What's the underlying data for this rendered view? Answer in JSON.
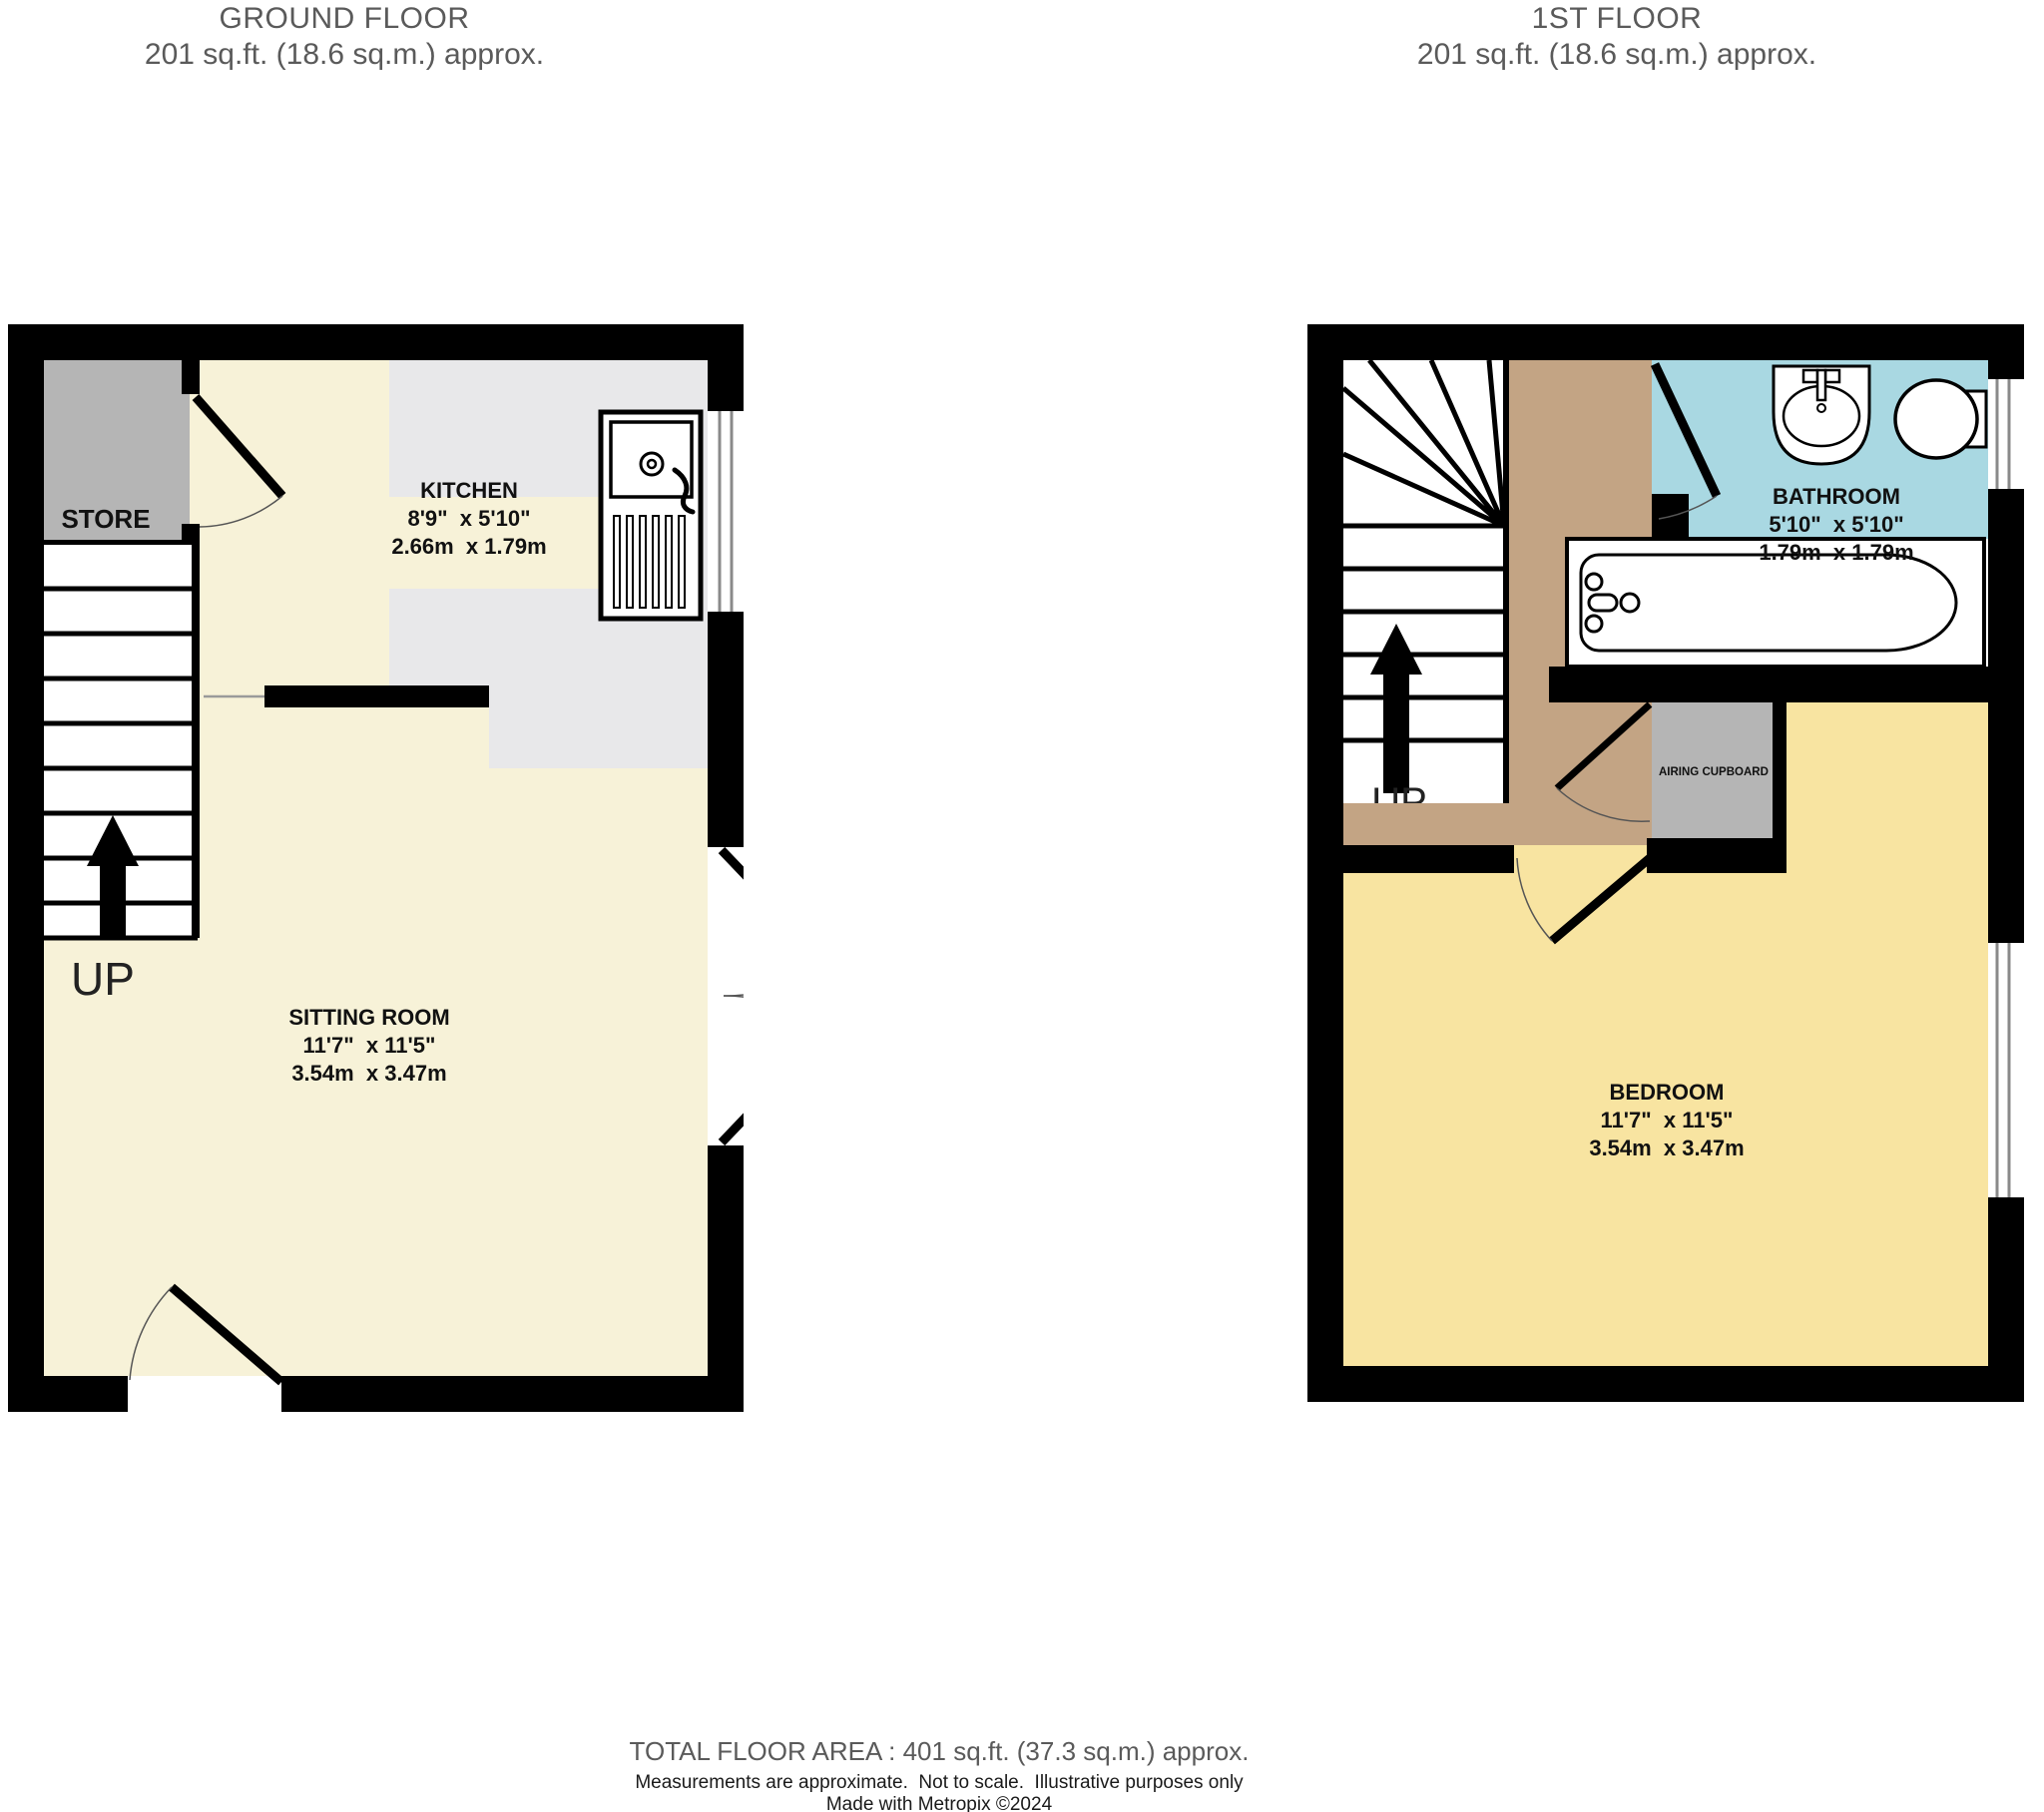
{
  "ground_floor": {
    "title": "GROUND FLOOR",
    "area_line": "201 sq.ft. (18.6 sq.m.) approx.",
    "store": {
      "label": "STORE"
    },
    "kitchen": {
      "label": "KITCHEN",
      "dims_imperial": "8'9\"  x 5'10\"",
      "dims_metric": "2.66m  x 1.79m"
    },
    "sitting_room": {
      "label": "SITTING ROOM",
      "dims_imperial": "11'7\"  x 11'5\"",
      "dims_metric": "3.54m  x 3.47m"
    },
    "stairs_label": "UP"
  },
  "first_floor": {
    "title": "1ST FLOOR",
    "area_line": "201 sq.ft. (18.6 sq.m.) approx.",
    "bathroom": {
      "label": "BATHROOM",
      "dims_imperial": "5'10\"  x 5'10\"",
      "dims_metric": "1.79m  x 1.79m"
    },
    "bedroom": {
      "label": "BEDROOM",
      "dims_imperial": "11'7\"  x 11'5\"",
      "dims_metric": "3.54m  x 3.47m"
    },
    "airing_cupboard": {
      "label": "AIRING CUPBOARD"
    },
    "stairs_label": "UP"
  },
  "footer": {
    "total": "TOTAL FLOOR AREA : 401 sq.ft. (37.3 sq.m.) approx.",
    "disclaimer": "Measurements are approximate.  Not to scale.  Illustrative purposes only",
    "credit": "Made with Metropix ©2024"
  },
  "colors": {
    "wall": "#000000",
    "floor_cream": "#f7f2d8",
    "kitchen_gray": "#e8e8ea",
    "store_gray": "#b5b5b5",
    "landing_tan": "#c3a484",
    "bathroom_blue": "#a9d8e2",
    "bedroom_yellow": "#f8e4a1",
    "heading_text": "#5a5a5a"
  }
}
